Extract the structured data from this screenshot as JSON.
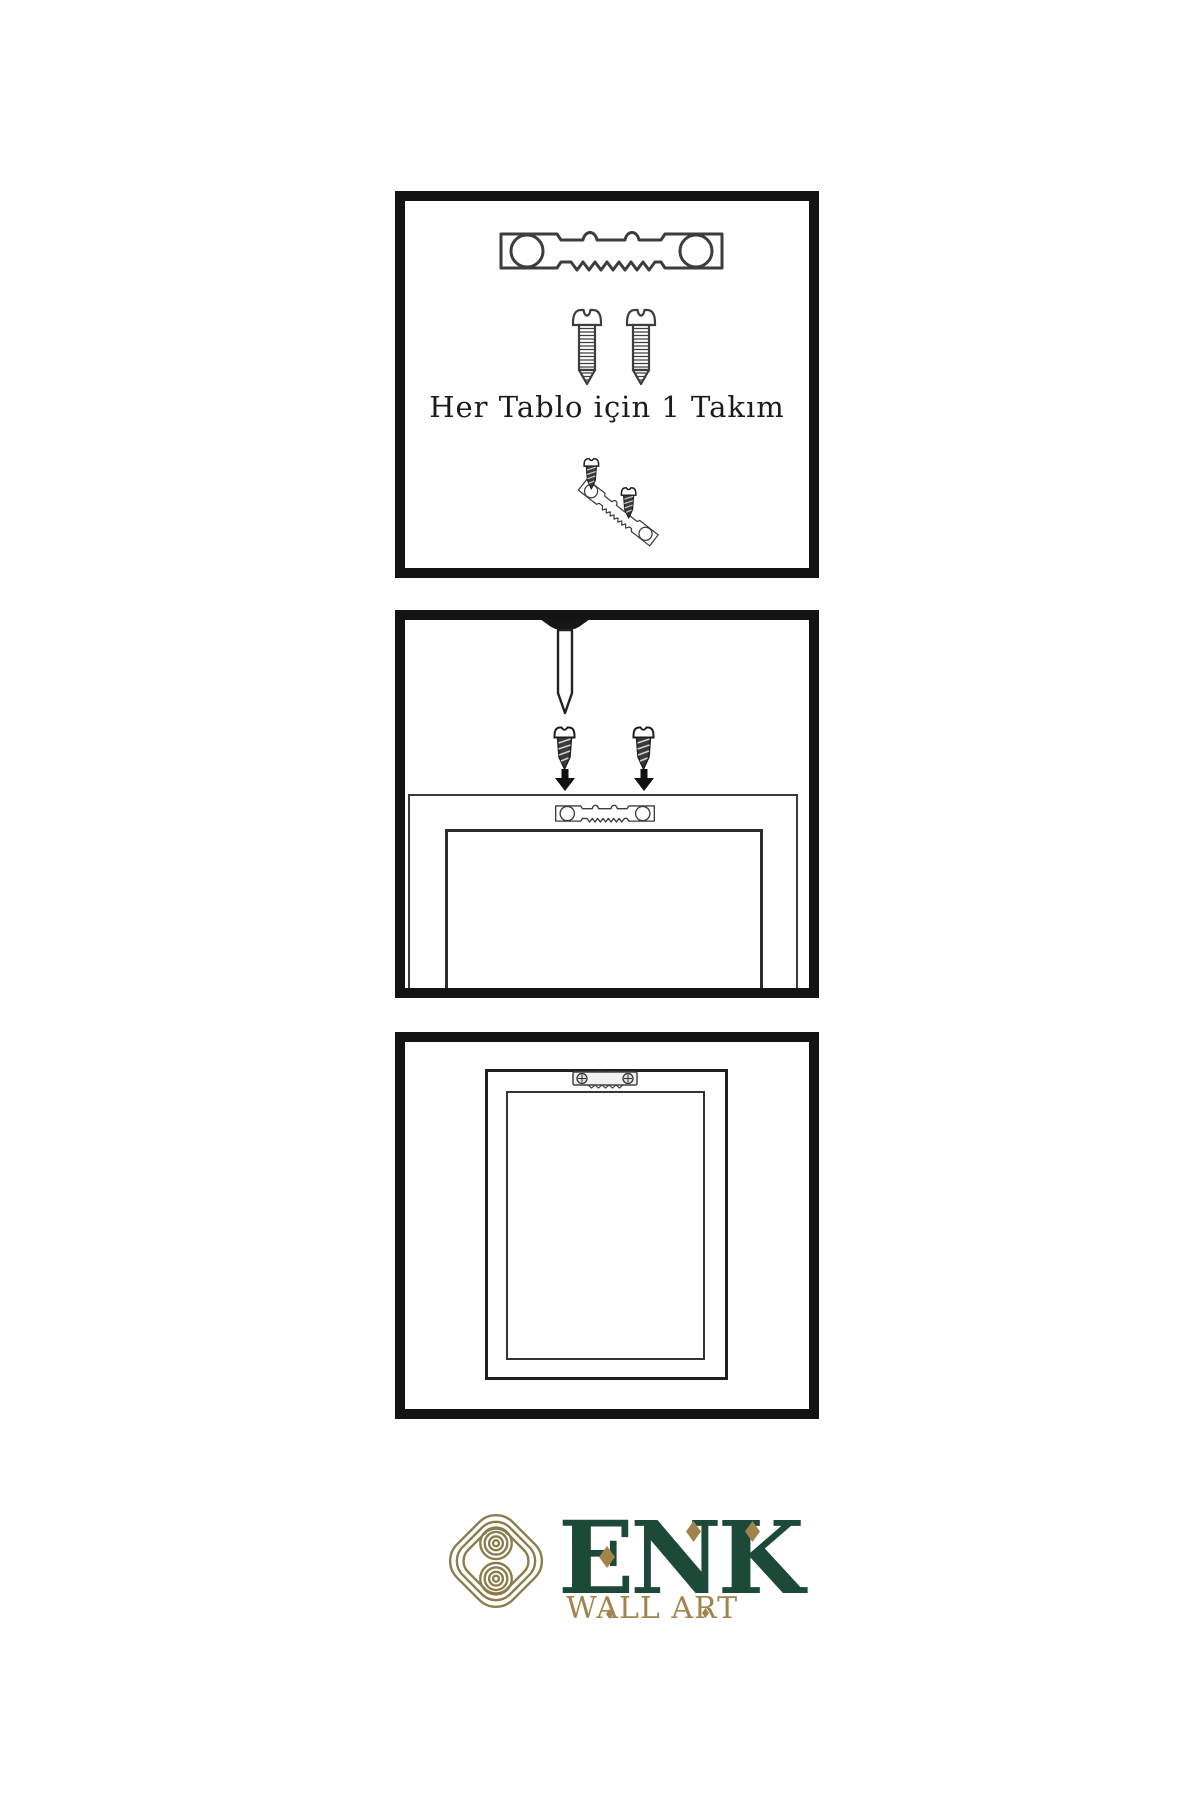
{
  "page": {
    "background": "#ffffff",
    "panel_border_color": "#131313",
    "line_art_color": "#3d3d3d"
  },
  "panels": {
    "step1": {
      "caption": "Her Tablo için 1 Takım",
      "icons": [
        "sawtooth-hanger-icon",
        "screw-icon",
        "screw-icon",
        "hanger-screw-assembly-icon"
      ]
    },
    "step2": {
      "icons": [
        "wall-nail-icon",
        "dark-screw-icon",
        "down-arrow-icon",
        "sawtooth-hanger-icon"
      ],
      "shapes": [
        "frame-back",
        "frame-back-inner"
      ]
    },
    "step3": {
      "icons": [
        "mounted-hanger-icon"
      ],
      "shapes": [
        "hanging-frame",
        "hanging-frame-inner"
      ]
    }
  },
  "brand": {
    "name": "ENK",
    "tagline": "WALL ART",
    "colors": {
      "green": "#1d4a38",
      "gold": "#a2834b",
      "emblem_gold": "#8a7c4b"
    },
    "icons": [
      "knot-emblem-icon",
      "diamond-accent-icon"
    ]
  }
}
